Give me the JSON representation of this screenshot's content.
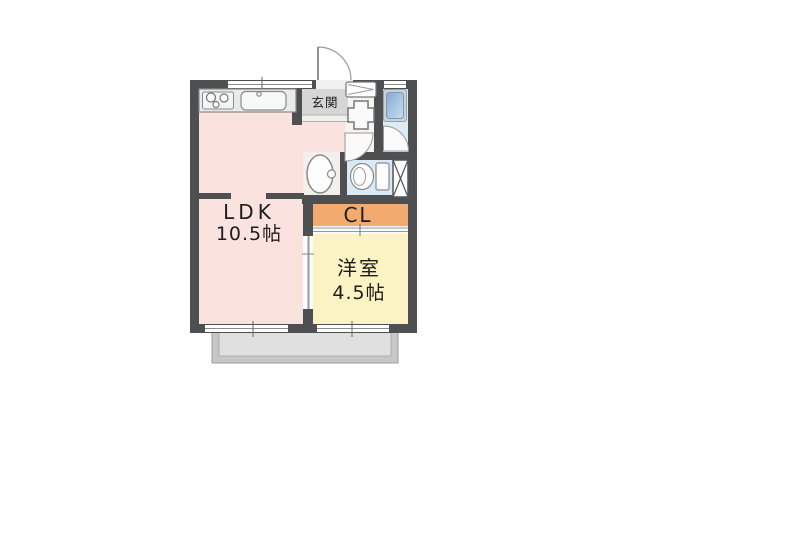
{
  "plan": {
    "type": "apartment-floor-plan",
    "rooms": {
      "ldk": {
        "name": "LDK",
        "size": "10.5帖"
      },
      "closet": {
        "label": "CL"
      },
      "western_room": {
        "name": "洋室",
        "size": "4.5帖"
      },
      "entrance": {
        "label": "玄関"
      }
    },
    "fixtures": [
      "kitchen-stove",
      "kitchen-sink",
      "entry-door",
      "shoe-cabinet",
      "washing-machine-space",
      "bathtub",
      "bath-door",
      "washroom-door",
      "washbasin",
      "toilet",
      "pipe-space",
      "sliding-door",
      "window-top",
      "window-bath",
      "window-ldk",
      "window-bedroom",
      "balcony"
    ],
    "colors": {
      "wall": "#4e4f51",
      "ldk_fill": "#fae2de",
      "bedroom_fill": "#fbf3c4",
      "closet_fill": "#f2aa6e",
      "entrance_fill": "#d6d6d6",
      "bath_fill": "#ddebf5",
      "toilet_fill": "#d9eaf6",
      "tub_blue": "#8fb4da",
      "balcony_fill": "#c7c7c7",
      "balcony_inner": "#e0e0e0",
      "fixture_stroke": "#8a8a8a",
      "text": "#1d1d1d"
    }
  }
}
